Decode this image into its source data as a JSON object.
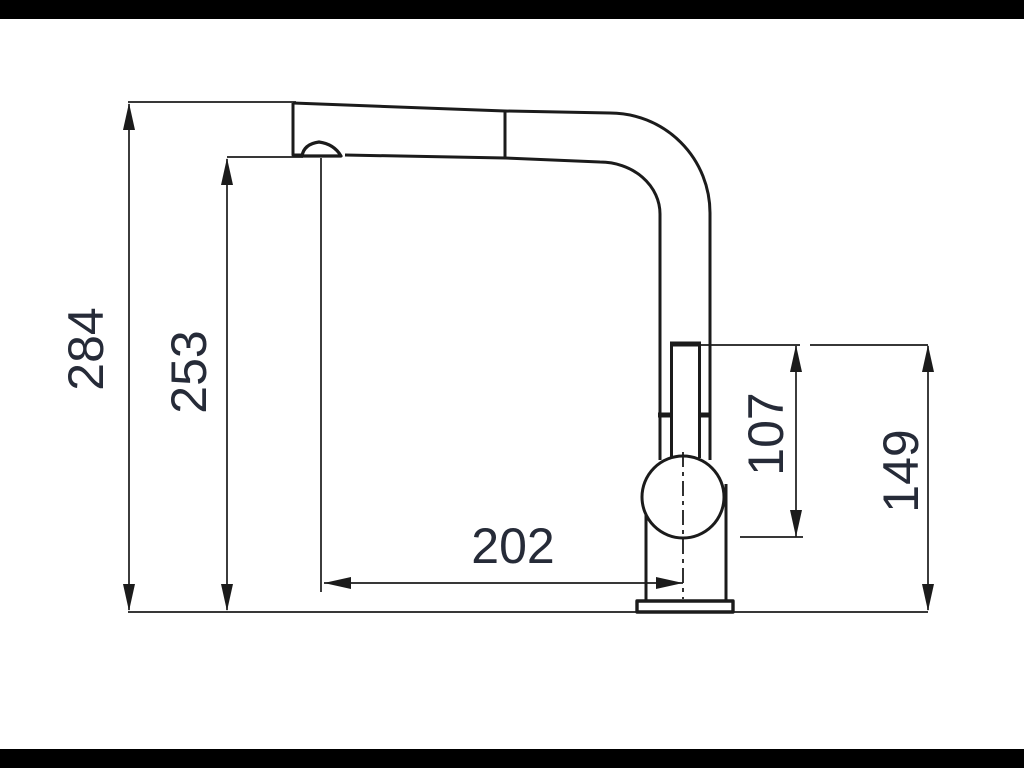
{
  "drawing": {
    "description": "Technical side-view dimension drawing of a single-lever kitchen mixer tap with pull-out spray head on a counter line",
    "unit_labels": {
      "overall_height": "284",
      "spout_outlet_height": "253",
      "spout_reach": "202",
      "body_to_handle_top": "107",
      "handle_top_height": "149"
    },
    "colors": {
      "letterbox": "#000000",
      "background": "#ffffff",
      "line": "#1b1b1b",
      "label_text": "#262b38"
    }
  }
}
